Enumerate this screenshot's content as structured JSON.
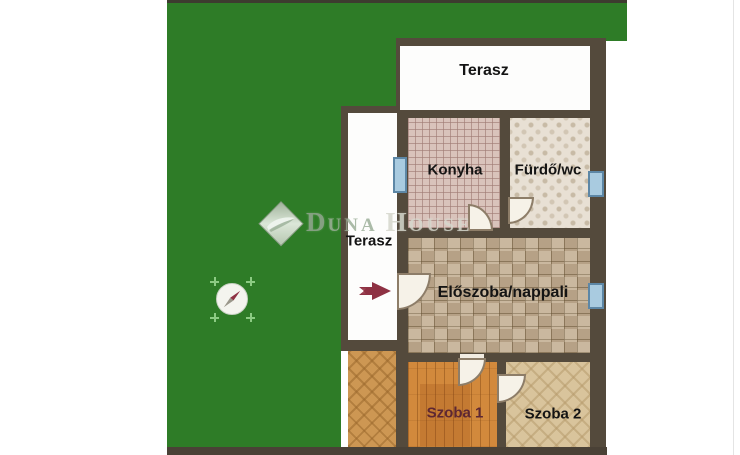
{
  "floorplan": {
    "rooms": {
      "terasz_top": {
        "label": "Terasz"
      },
      "konyha": {
        "label": "Konyha"
      },
      "furdo": {
        "label": "Fürdő/wc"
      },
      "terasz_side": {
        "label": "Terasz"
      },
      "eloszoba": {
        "label": "Előszoba/nappali"
      },
      "szoba1": {
        "label": "Szoba 1"
      },
      "szoba2": {
        "label": "Szoba 2"
      }
    },
    "watermark": {
      "full": "Duna House",
      "initial_d": "D",
      "rest_una": "UNA",
      "initial_h": "H",
      "rest_ouse": "OUSE"
    },
    "icons": {
      "compass": "compass-rose-north-east-needle",
      "entrance_arrow": "red-entrance-arrow-pointing-right"
    },
    "colors": {
      "garden_green": "#2e7c27",
      "wall_brown": "#544a3c",
      "window_blue": "#a9cbe0",
      "arrow_red": "#8e3143",
      "szoba1_label": "#5d2733",
      "watermark_green": "#93a791"
    }
  }
}
